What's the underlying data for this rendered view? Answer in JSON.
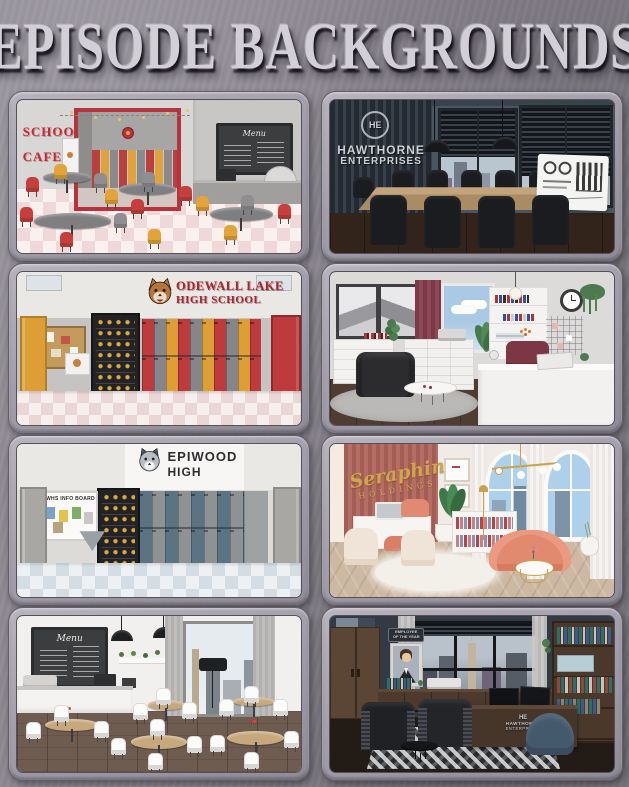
{
  "page": {
    "title": "EPISODE BACKGROUNDS"
  },
  "panels": [
    {
      "name": "school-cafeteria",
      "texts": {
        "sign_line1": "SCHOOL",
        "sign_line2": "CAFETERIA",
        "menu_title": "Menu"
      },
      "accent_colors": {
        "red": "#c5403c",
        "yellow": "#e2a33a",
        "gray": "#8f8f92"
      }
    },
    {
      "name": "hawthorne-conference-room",
      "texts": {
        "logo_initials": "HE",
        "company_line1": "HAWTHORNE",
        "company_line2": "ENTERPRISES"
      },
      "accent_colors": {
        "wall": "#49555f",
        "metal": "#ccd1d6"
      }
    },
    {
      "name": "odewall-lake-high-school-hallway",
      "texts": {
        "school_line1": "ODEWALL LAKE",
        "school_line2": "HIGH SCHOOL"
      },
      "accent_colors": {
        "red": "#bf3a3c",
        "yellow": "#dd9f35",
        "text": "#a8242e"
      }
    },
    {
      "name": "bright-modern-office",
      "texts": {}
    },
    {
      "name": "epiwood-high-hallway",
      "texts": {
        "school_line1": "EPIWOOD",
        "school_line2": "HIGH",
        "board_title": "EWHS INFO BOARD"
      },
      "accent_colors": {
        "blue": "#5b7484",
        "gray": "#8f9293"
      }
    },
    {
      "name": "seraphine-holdings-office",
      "texts": {
        "brand_line1": "Seraphine",
        "brand_line2": "HOLDINGS"
      },
      "accent_colors": {
        "rose": "#ab645c",
        "gold": "#cfa54e",
        "pink": "#e28a70"
      }
    },
    {
      "name": "coffee-shop",
      "texts": {
        "menu_title": "Menu"
      }
    },
    {
      "name": "hawthorne-executive-office",
      "texts": {
        "plaque_line1": "EMPLOYEE",
        "plaque_line2": "OF THE YEAR",
        "logo_initials": "HE",
        "company_line1": "HAWTHORNE",
        "company_line2": "ENTERPRISES"
      }
    }
  ]
}
